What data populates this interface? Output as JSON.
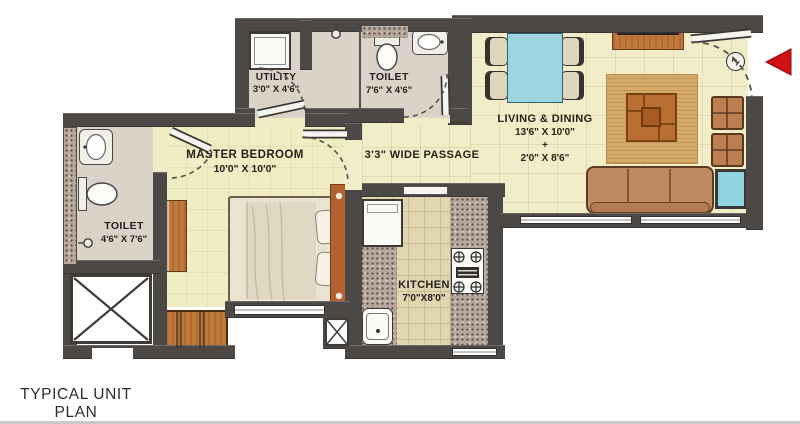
{
  "title": {
    "line1": "TYPICAL UNIT PLAN",
    "line2": "1 BHK"
  },
  "rooms": {
    "utility": {
      "name": "UTILITY",
      "dims": "3'0\" X 4'6\""
    },
    "toilet_top": {
      "name": "TOILET",
      "dims": "7'6\" X 4'6\""
    },
    "living_dining": {
      "name": "LIVING & DINING",
      "dims1": "13'6\" X 10'0\"",
      "plus": "+",
      "dims2": "2'0\" X 8'6\""
    },
    "passage": {
      "name": "3'3\" WIDE PASSAGE"
    },
    "master_bedroom": {
      "name": "MASTER BEDROOM",
      "dims": "10'0\" X 10'0\""
    },
    "toilet_left": {
      "name": "TOILET",
      "dims": "4'6\" X 7'6\""
    },
    "kitchen": {
      "name": "KITCHEN",
      "dims": "7'0\"X8'0\""
    }
  },
  "door_marker": {
    "label": "1"
  },
  "furniture_icons": [
    "washing-machine",
    "shower",
    "wc",
    "washbasin",
    "dining-table",
    "dining-chair",
    "tv-unit",
    "rug",
    "coffee-table",
    "pouf",
    "side-table",
    "sofa",
    "bed",
    "pillow",
    "wardrobe",
    "dresser",
    "refrigerator",
    "kitchen-sink",
    "stove",
    "shaft",
    "duct",
    "entry-arrow",
    "door-swing"
  ],
  "colors": {
    "wall": "#4c4845",
    "floor_living": "#f1edc9",
    "floor_bath": "#dbd3c8",
    "floor_kitchen": "#e0d6b2",
    "counter_granite": "#b7a89e",
    "wood_furniture": "#c0793c",
    "rug": "#d5ab67",
    "accent_blue": "#9fd4e3",
    "sofa": "#c08a62",
    "entry_arrow_red": "#d01217"
  }
}
